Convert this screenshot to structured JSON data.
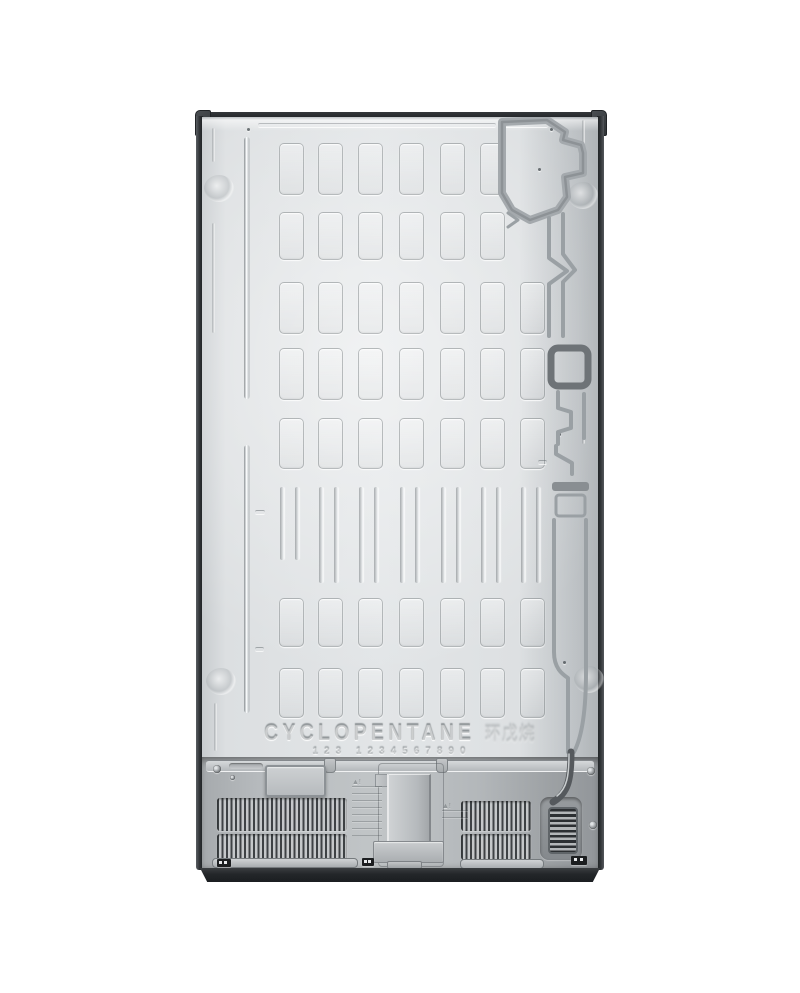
{
  "back_panel": {
    "refrigerant_label": "CYCLOPENTANE",
    "refrigerant_label_cn": "环戊烷",
    "embossed_digits": "123 1234567890"
  },
  "colors": {
    "background": "#ffffff",
    "panel_gray": "#e0e3e5",
    "compartment_gray": "#b3b7ba",
    "trim_dark": "#26292c",
    "channel_gray": "#9aa0a4"
  }
}
